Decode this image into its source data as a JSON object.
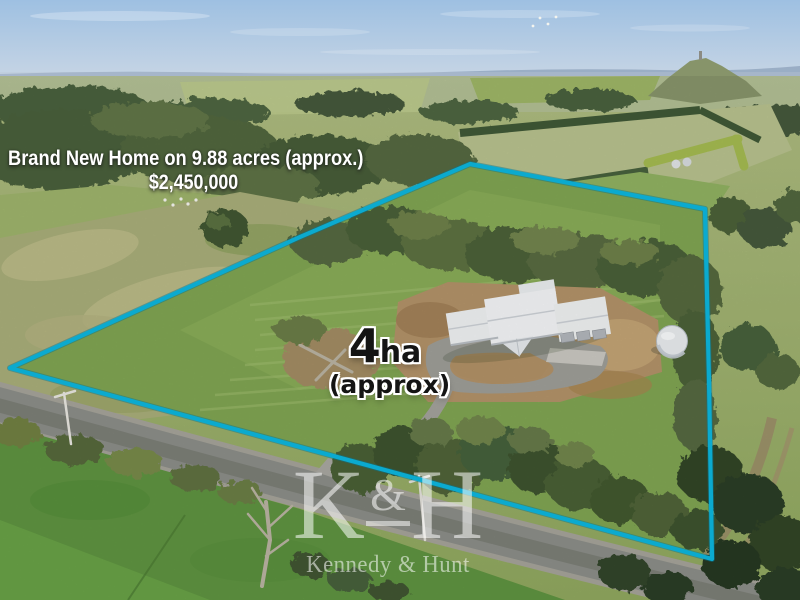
{
  "overlay": {
    "headline": "Brand New Home on 9.88 acres (approx.)",
    "price": "$2,450,000",
    "area": {
      "value": "4",
      "unit": "ha",
      "qualifier": "(approx)"
    }
  },
  "watermark": {
    "left_initial": "K",
    "ampersand": "&",
    "right_initial": "H",
    "agency_name": "Kennedy & Hunt"
  },
  "colors": {
    "boundary_line": "#0cb6dd",
    "headline_text": "#ffffff",
    "area_label_text": "#141414",
    "watermark_text": "rgba(255,255,255,0.55)",
    "sky_top": "#9ec0e2",
    "pasture_green": "#7fa452",
    "dirt_brown": "#b29268",
    "road_grey": "#8b8d88"
  }
}
